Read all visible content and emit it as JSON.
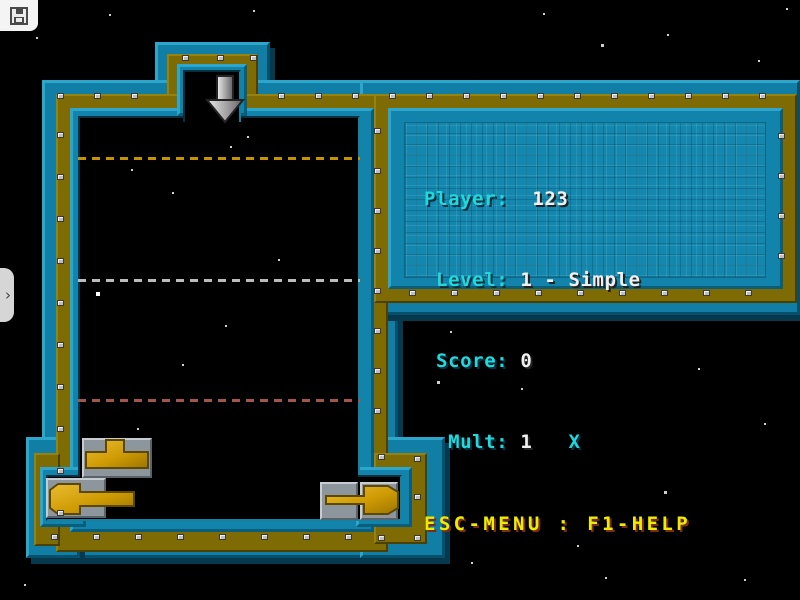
{
  "window": {
    "width": 800,
    "height": 600
  },
  "emulator_overlay": {
    "save_button_icon": "floppy-disk",
    "drawer_tab_icon": "chevron-right",
    "drawer_tab_glyph": "›"
  },
  "hud": {
    "player": "123",
    "level": "1",
    "level_name": "Simple",
    "score": "0",
    "mult": "1",
    "lines": [
      {
        "label": "Player:",
        "value": "  123"
      },
      {
        "label": " Level:",
        "value": " 1 - Simple"
      },
      {
        "label": " Score:",
        "value": " 0"
      },
      {
        "label": "  Mult:",
        "value": " 1   ",
        "suffix": "X"
      }
    ],
    "footer": "ESC-MENU : F1-HELP"
  },
  "game": {
    "chute_arrow": "down-arrow",
    "dashed_lines": [
      {
        "y": 157,
        "color": "#c49202"
      },
      {
        "y": 279,
        "color": "#bcbcbc"
      },
      {
        "y": 399,
        "color": "#a3554d"
      }
    ],
    "pieces": [
      {
        "name": "t-piece",
        "x": 82,
        "y": 438
      },
      {
        "name": "arrow-left-piece",
        "x": 46,
        "y": 476
      },
      {
        "name": "arrow-right-piece",
        "x": 318,
        "y": 478
      }
    ],
    "stars": [
      [
        253,
        10,
        2
      ],
      [
        543,
        13,
        2
      ],
      [
        109,
        14,
        2
      ],
      [
        786,
        8,
        2
      ],
      [
        601,
        44,
        3
      ],
      [
        667,
        34,
        2
      ],
      [
        758,
        60,
        2
      ],
      [
        36,
        37,
        2
      ],
      [
        131,
        169,
        2
      ],
      [
        247,
        136,
        2
      ],
      [
        230,
        146,
        2
      ],
      [
        172,
        192,
        2
      ],
      [
        278,
        259,
        2
      ],
      [
        96,
        292,
        4
      ],
      [
        225,
        325,
        2
      ],
      [
        182,
        364,
        2
      ],
      [
        137,
        428,
        2
      ],
      [
        450,
        331,
        2
      ],
      [
        437,
        381,
        3
      ],
      [
        521,
        388,
        2
      ],
      [
        698,
        368,
        2
      ],
      [
        664,
        491,
        3
      ],
      [
        577,
        545,
        2
      ],
      [
        764,
        423,
        2
      ],
      [
        605,
        577,
        2
      ],
      [
        471,
        562,
        2
      ],
      [
        24,
        584,
        2
      ],
      [
        744,
        579,
        2
      ]
    ],
    "colors": {
      "wall_teal": "#1181a8",
      "wall_olive": "#7e6b03",
      "gold": "#cf9b04",
      "tile_gray": "#8d959d",
      "text_cyan": "#21d8dd",
      "text_white": "#f0f0f0",
      "text_yellow": "#ecec00"
    }
  }
}
